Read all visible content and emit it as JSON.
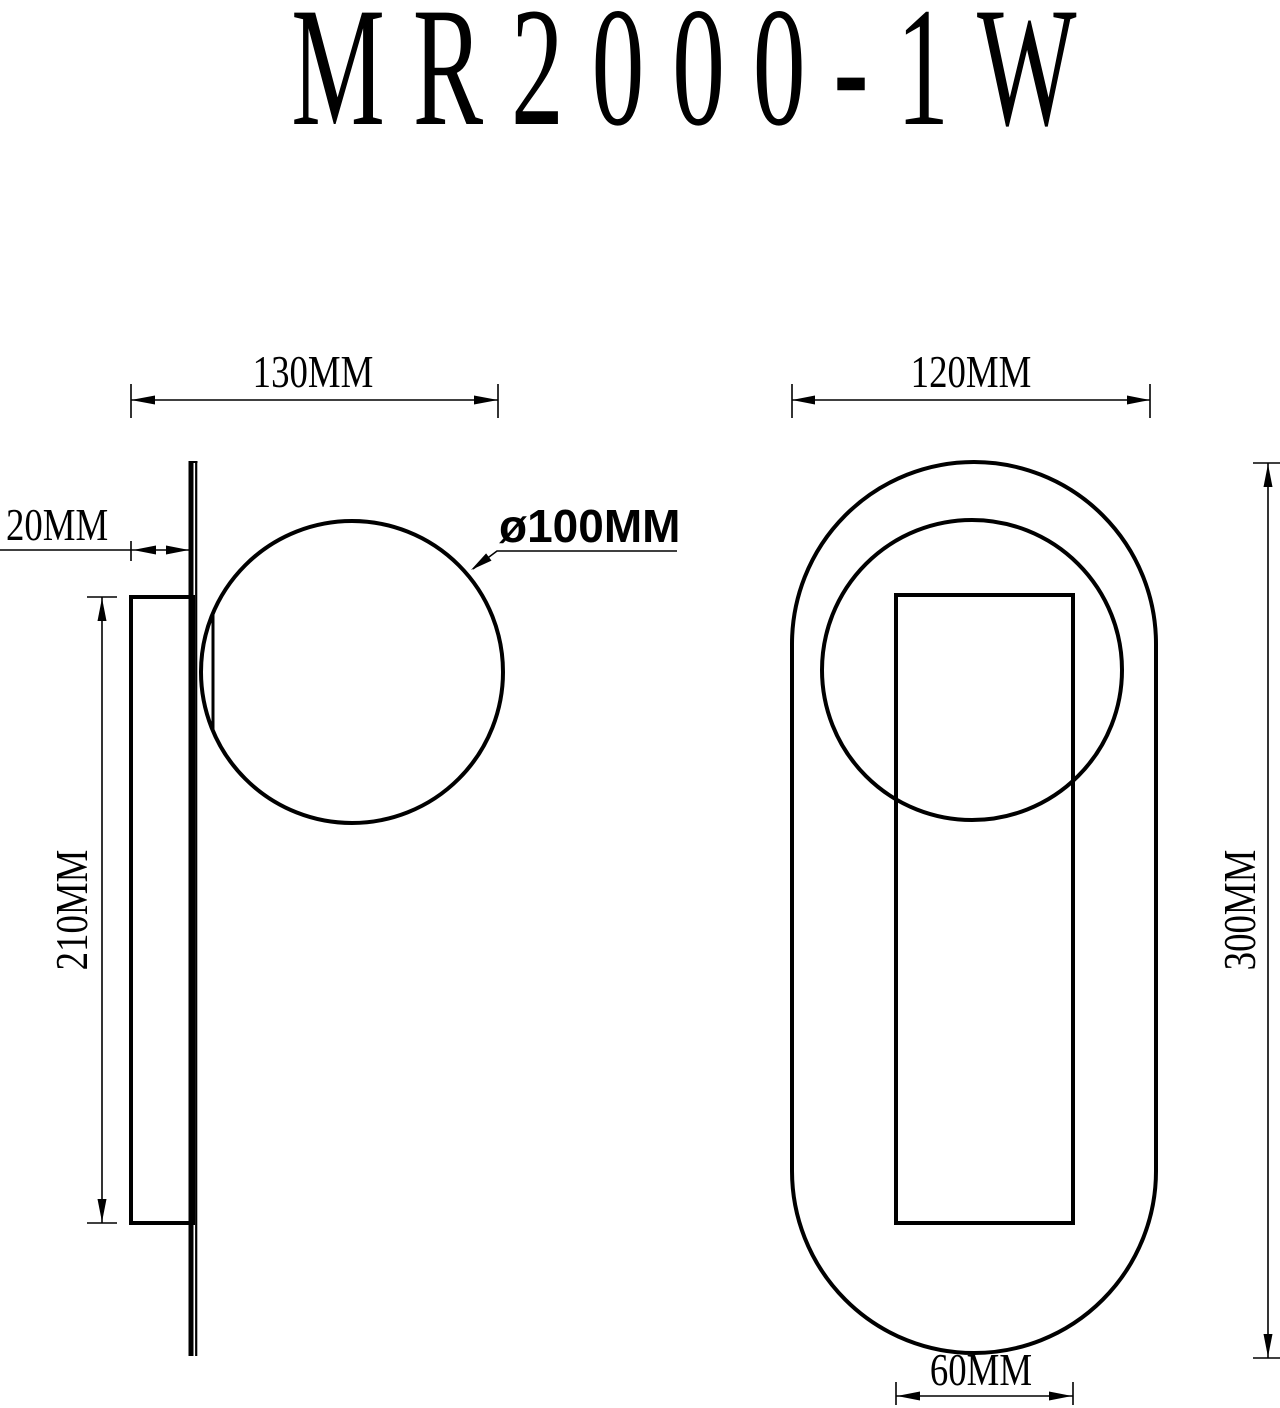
{
  "title": "MR2000-1W",
  "colors": {
    "line": "#000000",
    "background": "#ffffff"
  },
  "side_view": {
    "overall_depth_label": "130MM",
    "plate_depth_label": "20MM",
    "plate_height_label": "210MM",
    "globe_diameter_label": "ø100MM"
  },
  "front_view": {
    "overall_width_label": "120MM",
    "overall_height_label": "300MM",
    "inner_plate_width_label": "60MM"
  }
}
